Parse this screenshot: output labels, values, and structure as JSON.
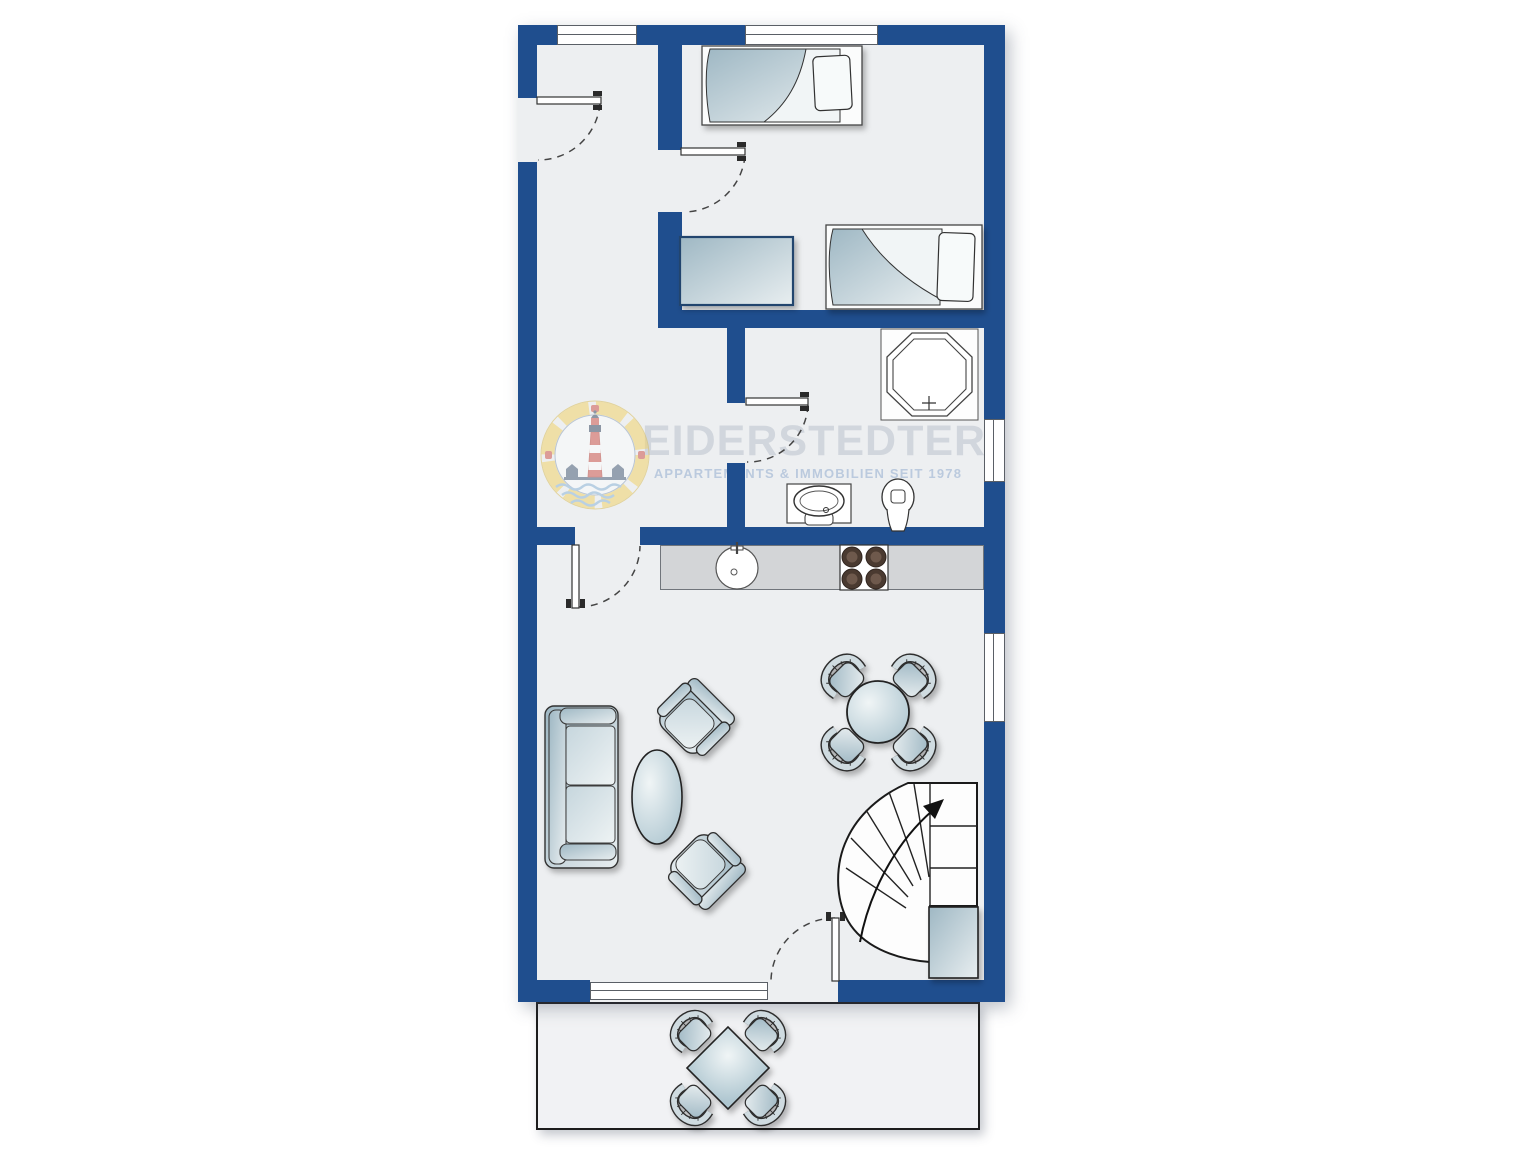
{
  "watermark": {
    "brand": "EIDERSTEDTER",
    "tagline": "APPARTEMENTS & IMMOBILIEN SEIT 1978"
  },
  "palette": {
    "wall_blue": "#1f4e8e",
    "floor_gray": "#edeff1",
    "terrace_gray": "#f1f2f4",
    "counter_gray": "#d3d5d7",
    "furniture_gradient_dark": "#9fb8c4",
    "furniture_gradient_light": "#e8eef0",
    "outline_dark": "#2f2f2f",
    "burner_brown": "#4a3a30",
    "watermark_text": "#aeb7c4",
    "watermark_tagline": "#7e9cc6",
    "logo_yellow": "#f2d36b",
    "logo_red": "#cf5950",
    "logo_blue": "#4e637c"
  },
  "floor_plan": {
    "type": "apartment upper floor plan, top view",
    "rooms": [
      "hallway",
      "bedroom with two single beds",
      "bathroom",
      "open kitchen and living room",
      "terrace"
    ],
    "doors": 5,
    "windows": 5,
    "fixtures": [
      "octagonal shower",
      "washbasin",
      "toilet",
      "kitchen sink",
      "stove with 4 burners"
    ],
    "furniture": [
      "single bed",
      "single bed",
      "wardrobe",
      "sofa",
      "coffee table",
      "armchair",
      "armchair",
      "round dining table with 4 chairs",
      "quarter-turn winder staircase",
      "under-stair cupboard",
      "terrace table with 4 chairs"
    ],
    "stair_direction": "up"
  }
}
